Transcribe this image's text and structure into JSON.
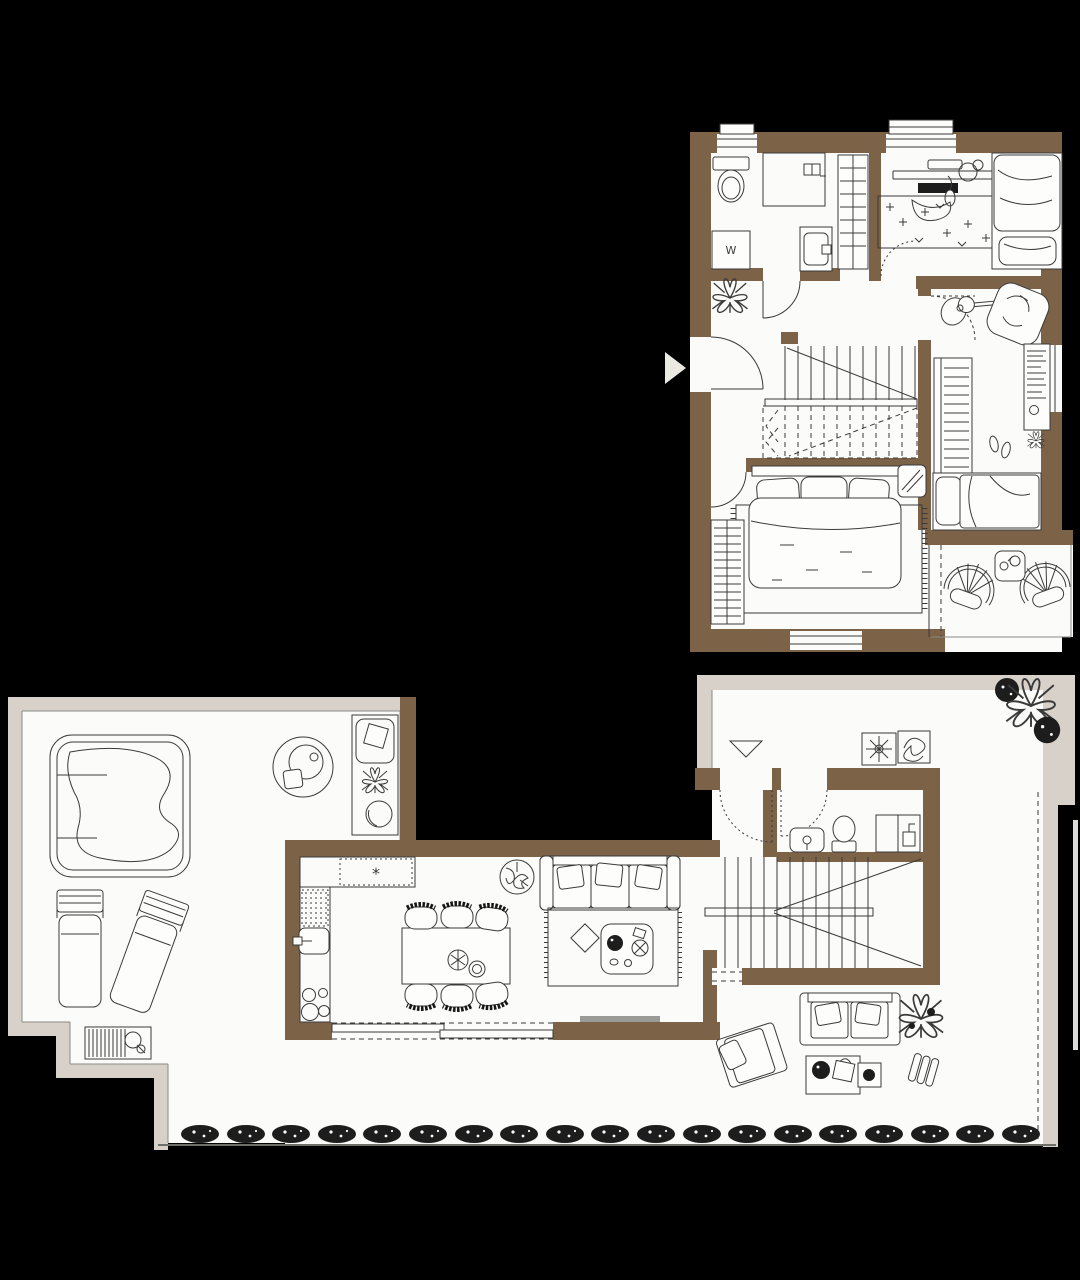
{
  "scene": {
    "type": "architectural floor plan, two levels, top-down",
    "background_color": "#000000",
    "wall_color": "#7c6246",
    "floor_color": "#fbfbf9",
    "terrace_border_color": "#d8d1c9",
    "line_color": "#3a3a3a"
  },
  "upper_floor": {
    "name": "upper floor plan (top right)",
    "labels": {
      "washing_machine": "W"
    },
    "rooms": [
      {
        "name": "bathroom",
        "furniture": [
          "toilet",
          "shower",
          "washing-machine",
          "sink",
          "closet"
        ]
      },
      {
        "name": "kids-room",
        "furniture": [
          "desk",
          "keyboard",
          "headphones",
          "mouse",
          "chair",
          "patterned-rug",
          "bed"
        ]
      },
      {
        "name": "second-bedroom",
        "furniture": [
          "guitar",
          "bean-bag",
          "wardrobe",
          "bookshelf",
          "slippers",
          "single-bed"
        ]
      },
      {
        "name": "hallway",
        "furniture": [
          "plant",
          "staircase",
          "entry-door"
        ]
      },
      {
        "name": "master-bedroom",
        "furniture": [
          "double-bed",
          "pillows",
          "rug",
          "radiator",
          "mirror"
        ]
      },
      {
        "name": "balcony",
        "furniture": [
          "wicker-chair",
          "wicker-chair",
          "side-table"
        ]
      }
    ]
  },
  "lower_floor": {
    "name": "ground floor plan (bottom)",
    "labels": {
      "cooktop": "*"
    },
    "rooms": [
      {
        "name": "terrace",
        "furniture": [
          "hot-tub",
          "round-side-table",
          "outdoor-counter",
          "sun-lounger",
          "sun-lounger",
          "deck-shower"
        ]
      },
      {
        "name": "kitchen",
        "furniture": [
          "counter",
          "cooktop",
          "dishwasher",
          "sink",
          "stove-burners"
        ]
      },
      {
        "name": "dining-area",
        "furniture": [
          "dining-table",
          "six-chairs",
          "table-plant",
          "bowl"
        ]
      },
      {
        "name": "living-room",
        "furniture": [
          "sofa",
          "rug",
          "coffee-table",
          "floor-plant",
          "sliding-door"
        ]
      },
      {
        "name": "bathroom",
        "furniture": [
          "vanity",
          "toilet",
          "shower"
        ]
      },
      {
        "name": "entry-court",
        "furniture": [
          "entry-marker",
          "planter",
          "planter",
          "bushes"
        ]
      },
      {
        "name": "staircase",
        "furniture": []
      },
      {
        "name": "garden",
        "furniture": [
          "outdoor-sofa",
          "armchair",
          "low-tables",
          "plants",
          "folded-lounger",
          "hedge-row"
        ]
      }
    ]
  }
}
